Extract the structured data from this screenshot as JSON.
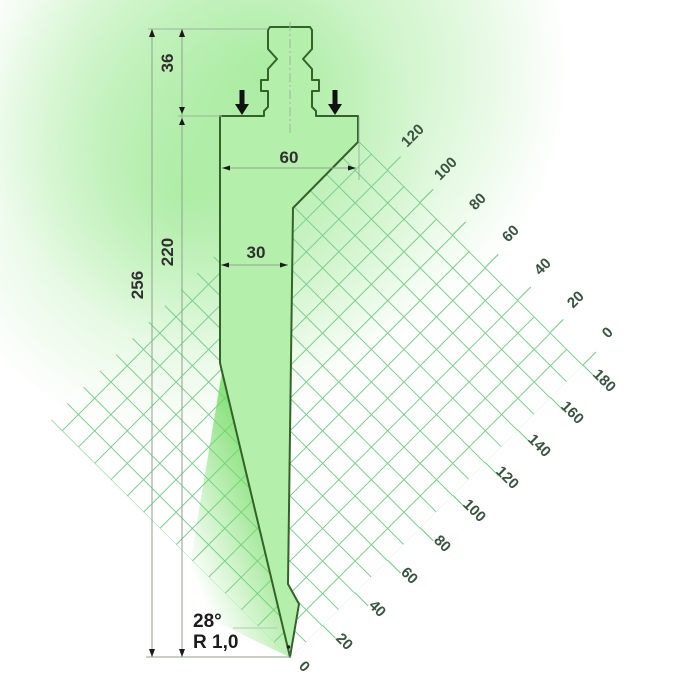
{
  "drawing": {
    "type": "press-brake-punch-profile",
    "dimensions": {
      "head_width": "60",
      "body_width": "30",
      "shank_height": "36",
      "working_height": "220",
      "total_height": "256"
    },
    "tip": {
      "angle": "28°",
      "radius": "R 1,0"
    },
    "scales": {
      "top_right": [
        "0",
        "20",
        "40",
        "60",
        "80",
        "100",
        "120"
      ],
      "bottom_right": [
        "0",
        "20",
        "40",
        "60",
        "80",
        "100",
        "120",
        "140",
        "160",
        "180"
      ]
    },
    "colors": {
      "punch_fill": "#b4f0ab",
      "punch_outline": "#336329",
      "grid_line": "#7bcd8e",
      "glow": "#86e47a",
      "dimension_line": "#8fa28f",
      "dimension_text": "#2f2f2f",
      "scale_text": "#3b5340"
    }
  }
}
